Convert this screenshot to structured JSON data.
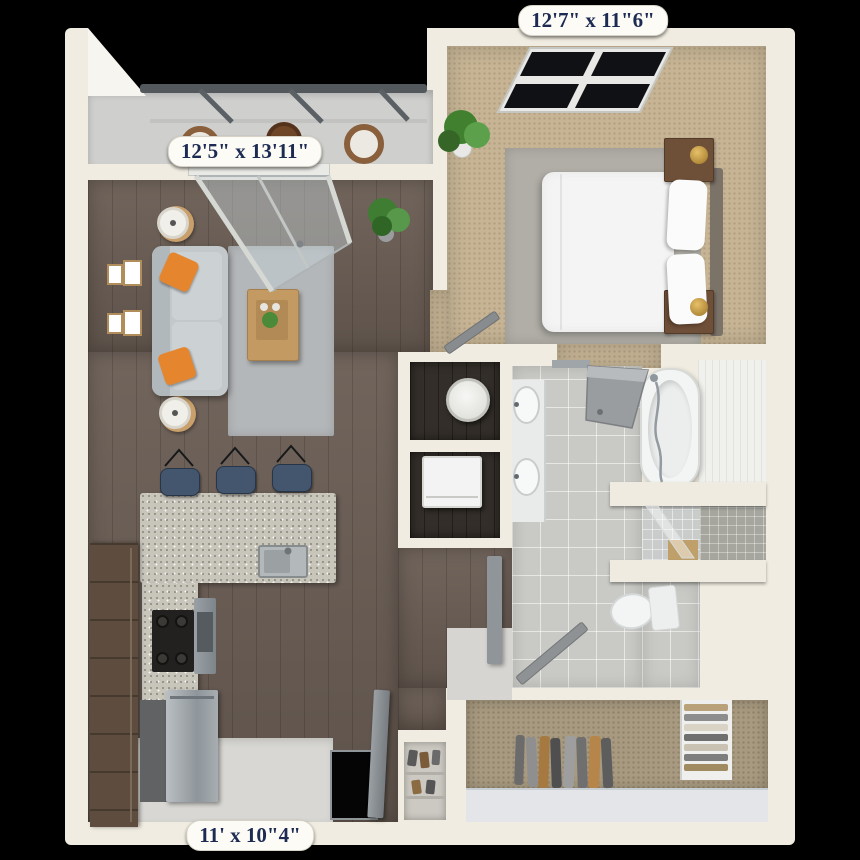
{
  "title": "3d-apartment-floor-plan",
  "labels": {
    "bedroom": "12'7\" x 11\"6\"",
    "living": "12'5\" x 13'11\"",
    "kitchen": "11' x 10\"4\""
  },
  "palette": {
    "background": "#000000",
    "wall_cream": "#f0ece1",
    "wood_floor": "#695c53",
    "bedroom_carpet": "#c6b495",
    "closet_carpet": "#a89a80",
    "bath_tile": "#c9c9c5",
    "granite_counter": "#c8c5bb",
    "cabinet_brown": "#5e4c3e",
    "stainless": "#9aa1a6",
    "sofa_gray": "#c3c8cb",
    "pillow_orange": "#e5862f",
    "stool_blue": "#44566e",
    "rug_gray": "#b4b7b9",
    "balcony_floor": "#cfd0ce",
    "railing_gray": "#53585c",
    "door_gray": "#8b8e90",
    "bed_white": "#f3f4f3",
    "accent_wood": "#c49a63",
    "plant_green": "#4a8a38",
    "label_text": "#1d2b52",
    "label_background": "#fcfbf6"
  }
}
